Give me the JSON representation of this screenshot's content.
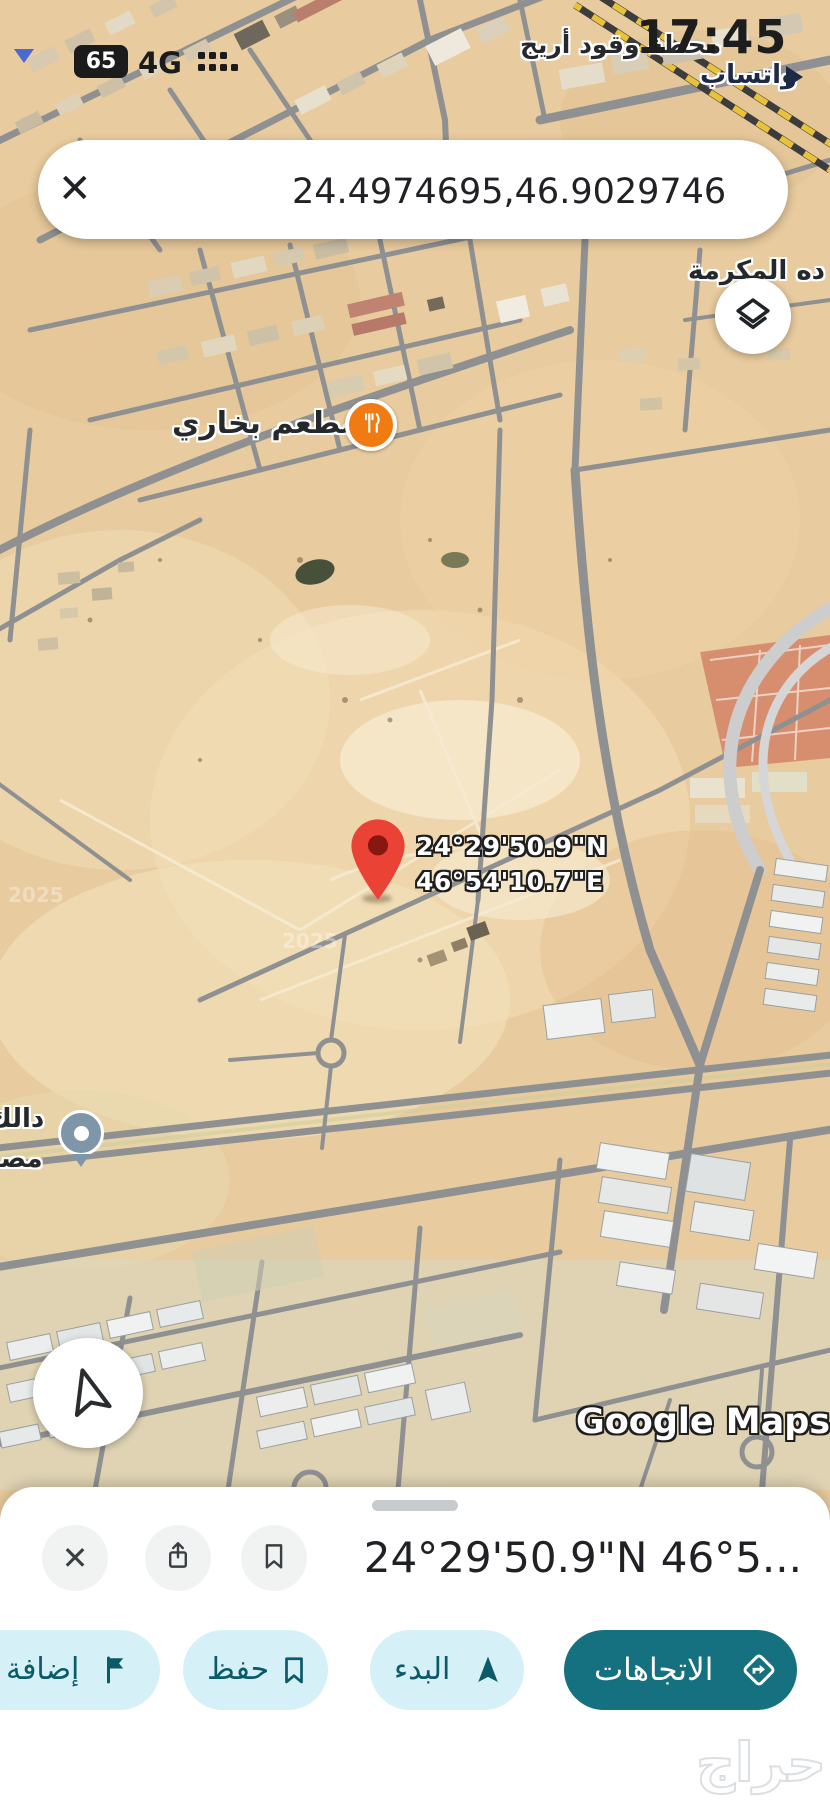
{
  "status_bar": {
    "battery": "65",
    "network": "4G",
    "time": "17:45"
  },
  "search_bar": {
    "query": "24.4974695,46.9029746"
  },
  "icons": {
    "close": "✕"
  },
  "map": {
    "labels": {
      "fuel_station": "محطة وقود أريج",
      "whatsapp": "واتساب",
      "district": "ده المكرمة",
      "restaurant": "مطعم بخاري",
      "left_partial_top": "دالك",
      "left_partial_bottom": "مصـ"
    },
    "pin": {
      "line1": "24°29'50.9\"N",
      "line2": "46°54'10.7\"E"
    },
    "watermark": "Google Maps",
    "imagery_year": "2025"
  },
  "bottom_sheet": {
    "title": "24°29'50.9\"N 46°5...",
    "actions": {
      "directions": "الاتجاهات",
      "start": "البدء",
      "save": "حفظ",
      "add": "إضافة"
    }
  },
  "branding": {
    "haraj": "حراج"
  },
  "colors": {
    "accent_teal": "#15707f",
    "accent_teal_light": "#d5f0f6",
    "accent_teal_dark": "#0a5a68",
    "pin_red": "#ea4335",
    "poi_orange": "#f07b12",
    "poi_blue": "#4b69cf"
  }
}
